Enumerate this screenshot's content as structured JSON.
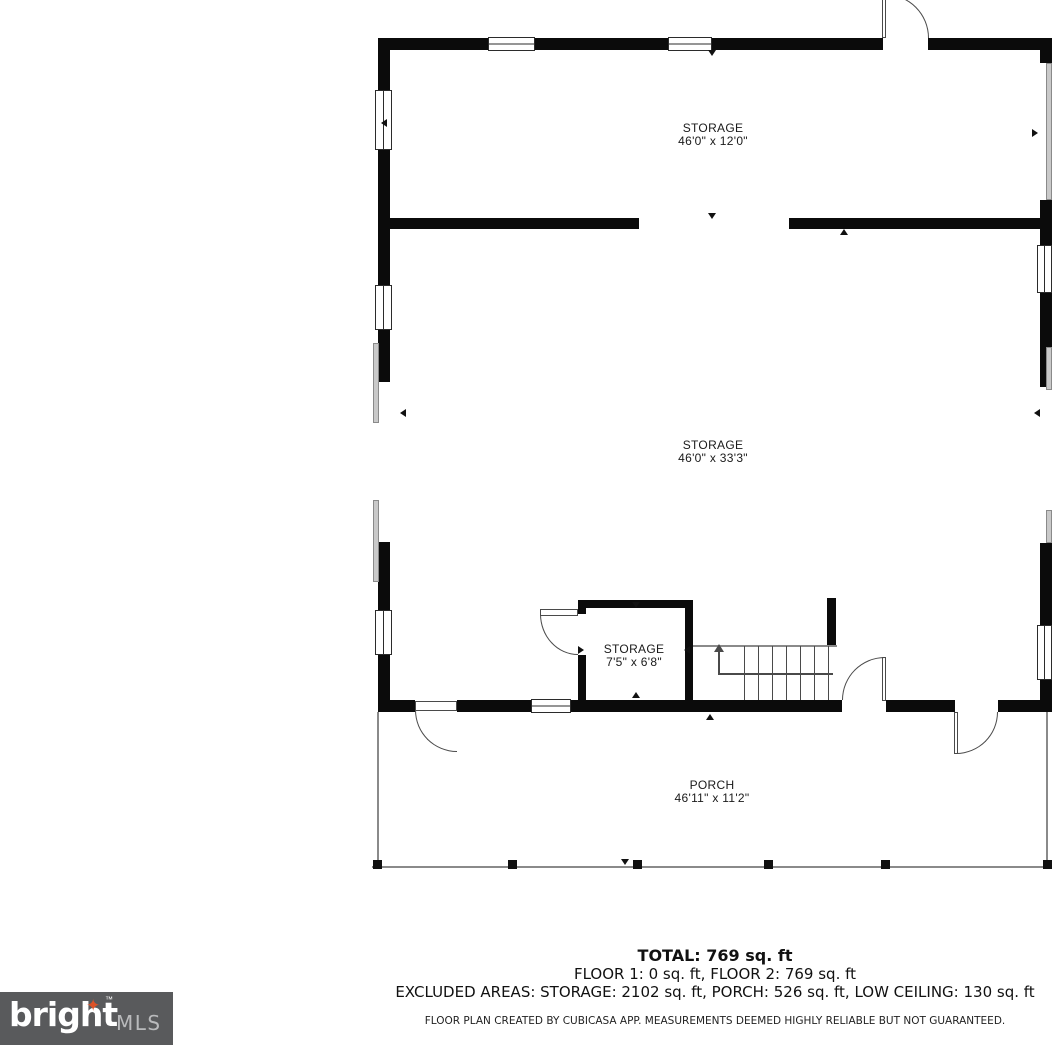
{
  "plan": {
    "rooms": [
      {
        "name": "STORAGE",
        "dims": "46'0\" x 12'0\""
      },
      {
        "name": "STORAGE",
        "dims": "46'0\" x 33'3\""
      },
      {
        "name": "STORAGE",
        "dims": "7'5\" x 6'8\""
      },
      {
        "name": "PORCH",
        "dims": "46'11\" x 11'2\""
      }
    ],
    "stairs": {
      "direction_arrow": "up"
    }
  },
  "summary": {
    "total": "TOTAL: 769 sq. ft",
    "floors": "FLOOR 1: 0 sq. ft, FLOOR 2: 769 sq. ft",
    "excluded": "EXCLUDED AREAS: STORAGE: 2102 sq. ft, PORCH: 526 sq. ft, LOW CEILING: 130 sq. ft",
    "disclaimer": "FLOOR PLAN CREATED BY CUBICASA APP. MEASUREMENTS DEEMED HIGHLY RELIABLE BUT NOT GUARANTEED."
  },
  "branding": {
    "name": "bright",
    "suffix": "MLS",
    "trademark": "™",
    "star_icon": "✦",
    "colors": {
      "background": "#595a5c",
      "text": "#ffffff",
      "suffix_text": "#b9babc",
      "star": "#DD5227"
    }
  },
  "colors": {
    "wall": "#0b0b0b",
    "background": "#ffffff"
  }
}
